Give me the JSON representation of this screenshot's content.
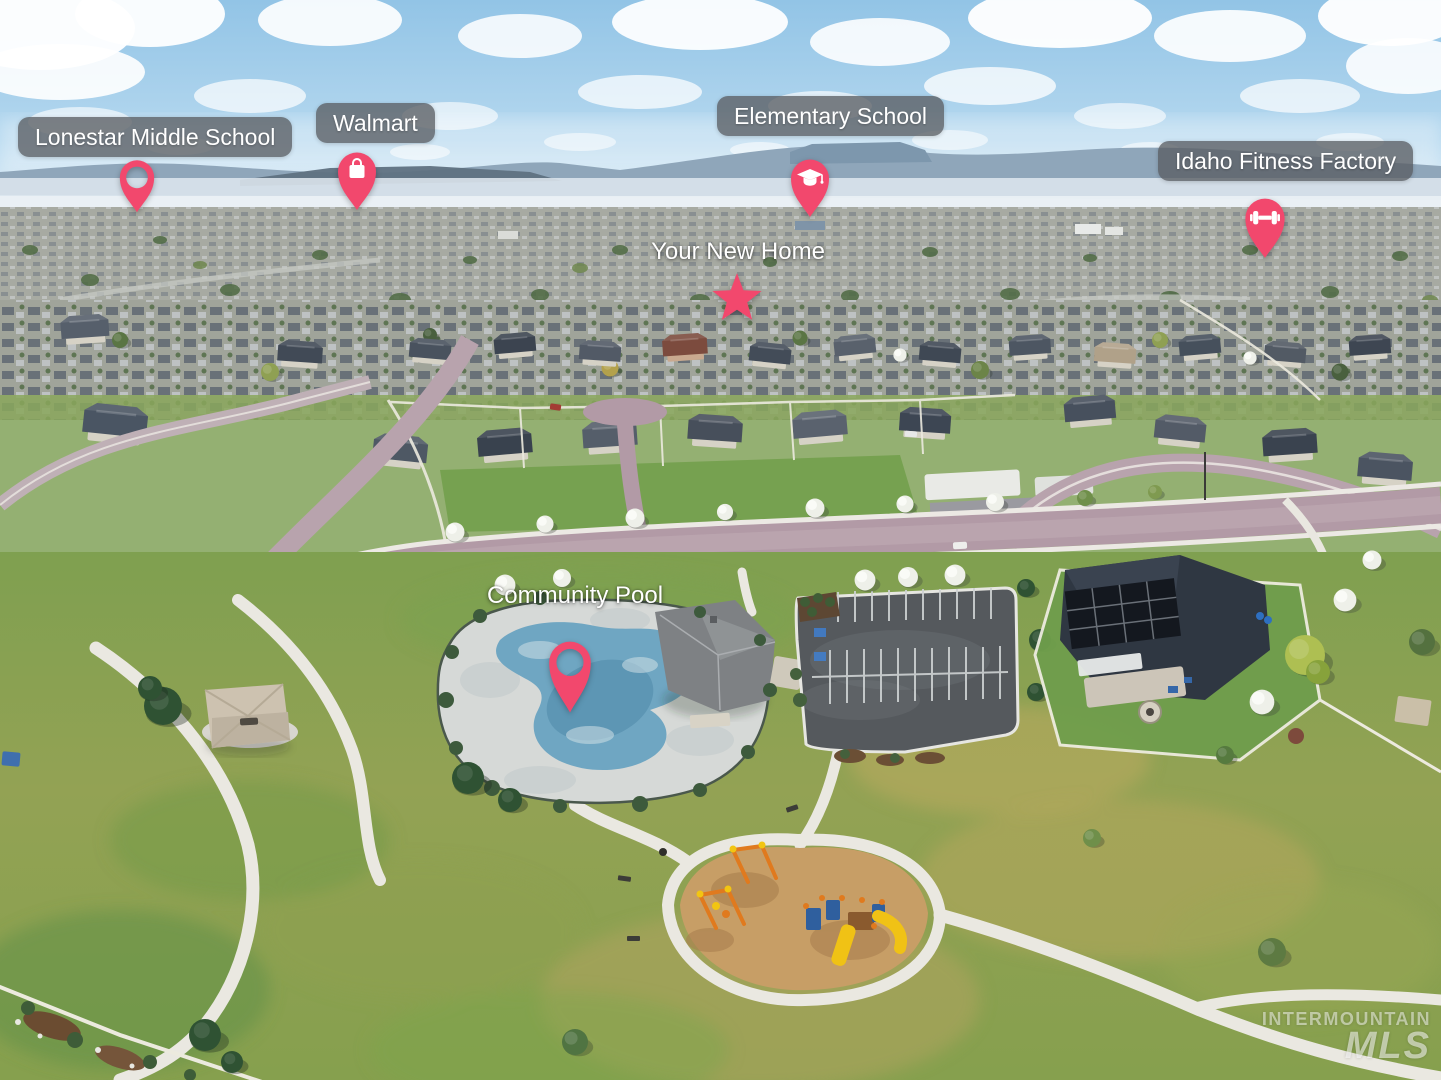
{
  "annotations": {
    "lonestar": {
      "text": "Lonestar Middle School",
      "icon": "location-ring-pin-icon"
    },
    "walmart": {
      "text": "Walmart",
      "icon": "shopping-bag-pin-icon"
    },
    "elementary": {
      "text": "Elementary School",
      "icon": "graduation-cap-pin-icon"
    },
    "fitness": {
      "text": "Idaho Fitness Factory",
      "icon": "dumbbell-pin-icon"
    },
    "home": {
      "text": "Your New Home",
      "icon": "star-icon"
    },
    "pool": {
      "text": "Community Pool",
      "icon": "location-ring-pin-icon"
    }
  },
  "watermark": {
    "line1": "INTERMOUNTAIN",
    "line2": "MLS"
  },
  "colors": {
    "pin_accent": "#F2486D",
    "label_bg": "rgba(90,94,99,0.78)",
    "label_text": "#FFFFFF",
    "sky": "#9DCBE9",
    "pool_water": "#6FA6C2",
    "asphalt": "#55595D",
    "road": "#B29AA6",
    "grass": "#7FA050",
    "mulch": "#C79E66"
  }
}
